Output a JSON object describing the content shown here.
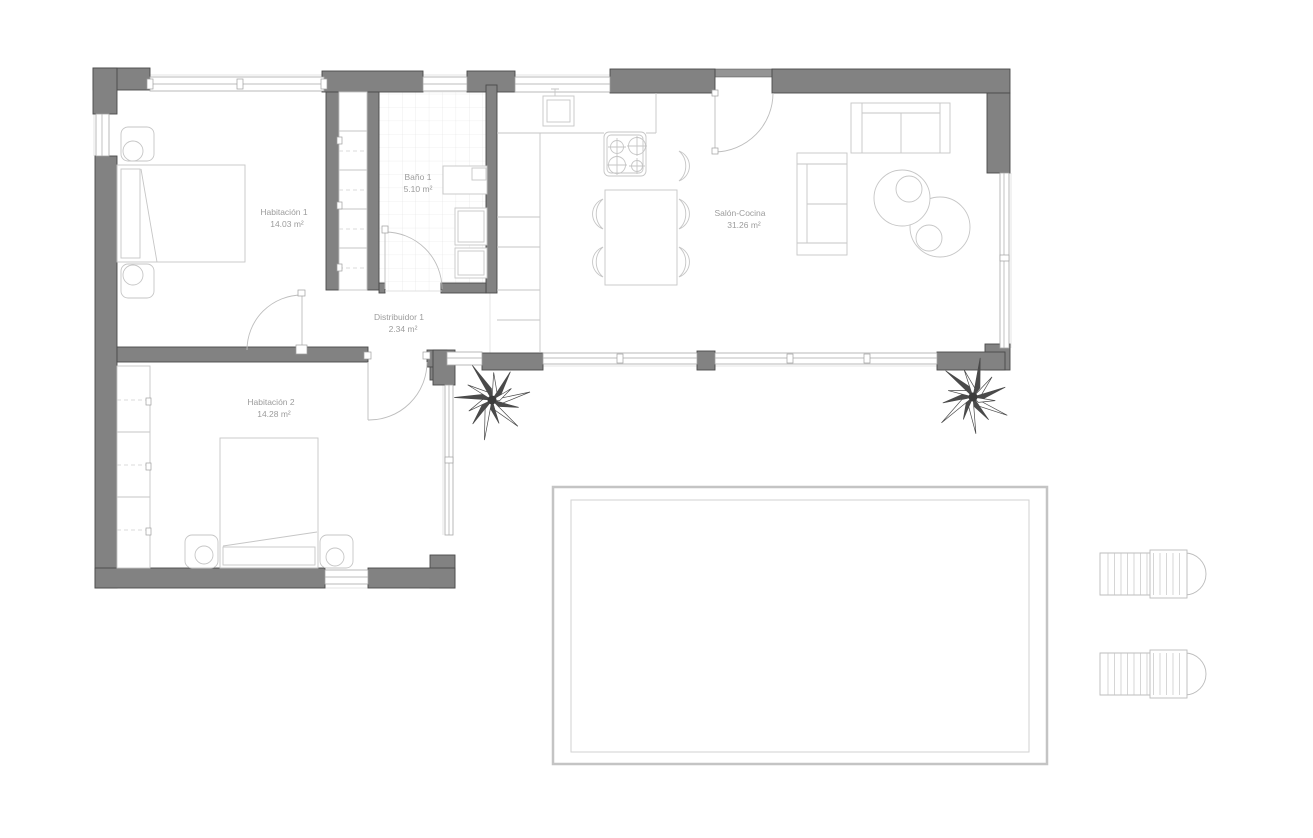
{
  "plan": {
    "rooms": [
      {
        "name": "Habitación 1",
        "area": "14.03 m²"
      },
      {
        "name": "Baño 1",
        "area": "5.10 m²"
      },
      {
        "name": "Salón-Cocina",
        "area": "31.26 m²"
      },
      {
        "name": "Distribuidor 1",
        "area": "2.34 m²"
      },
      {
        "name": "Habitación 2",
        "area": "14.28 m²"
      }
    ],
    "colors": {
      "wall": "#828282",
      "window_line": "#a9a9a9",
      "furniture_line": "#c6c6c6",
      "label_text": "#9c9c9c"
    }
  }
}
